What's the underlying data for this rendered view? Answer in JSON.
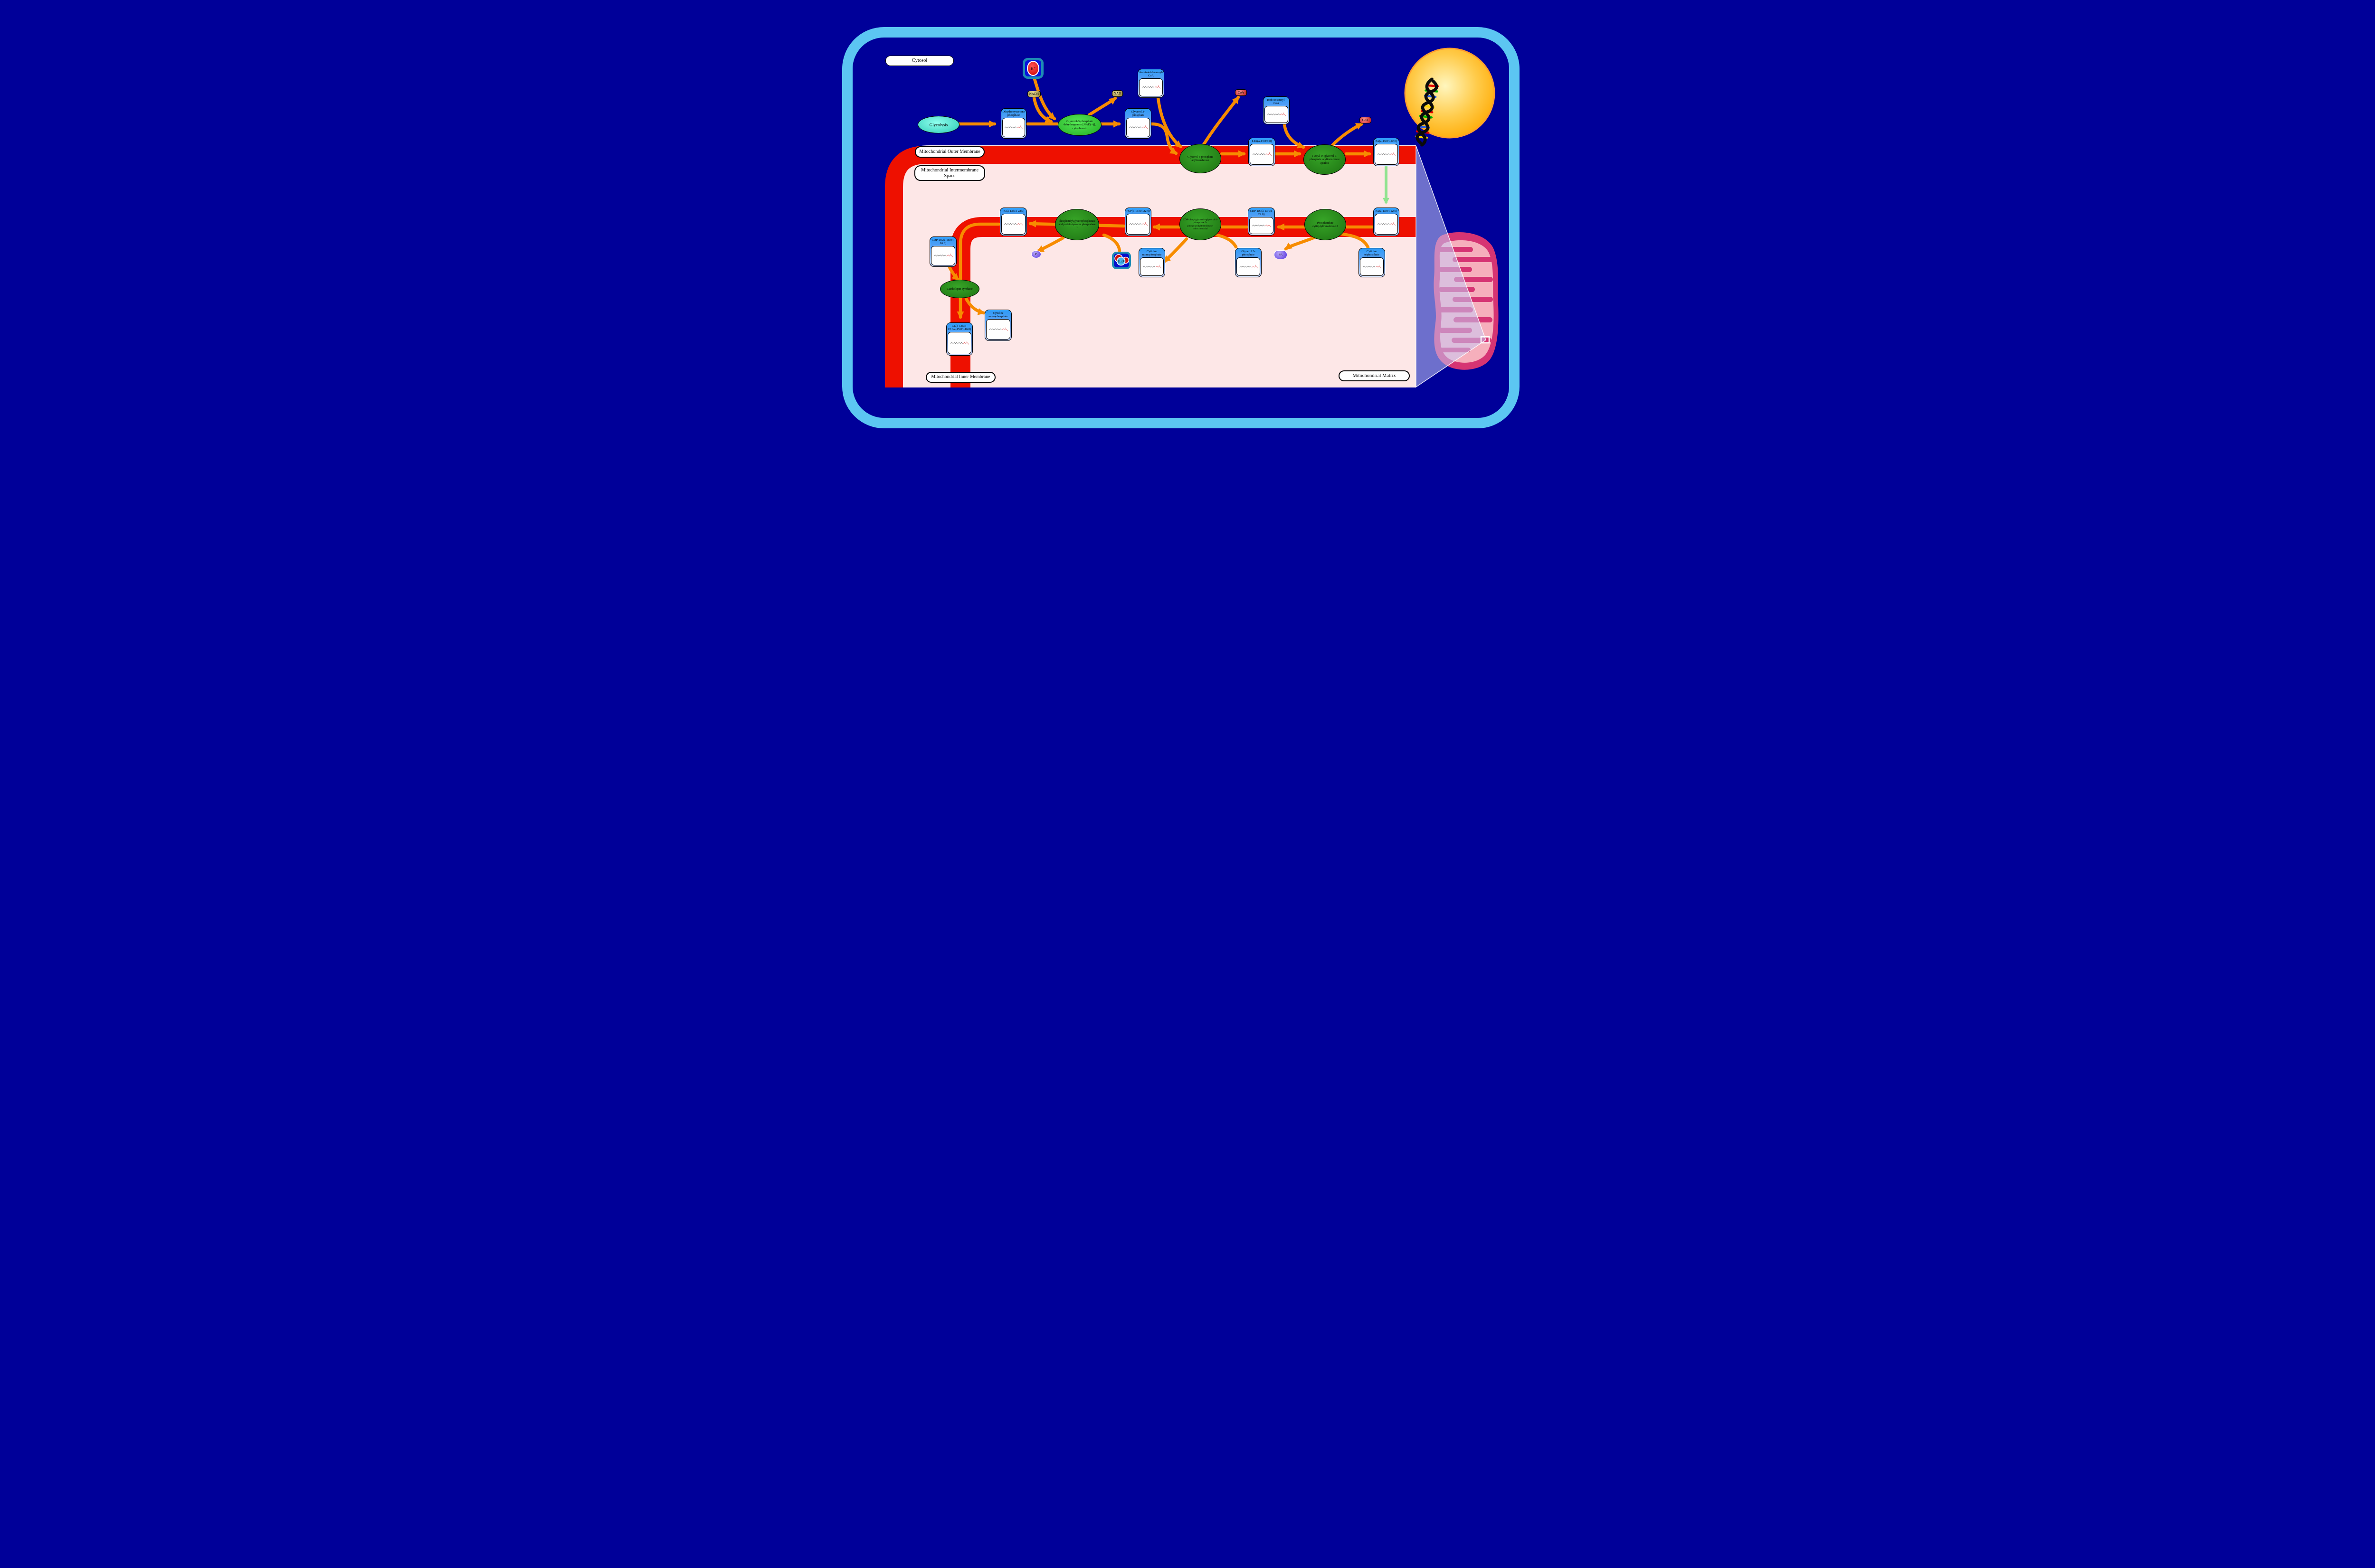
{
  "compartments": {
    "cytosol": "Cytosol",
    "outer_membrane": "Mitochondrial Outer Membrane",
    "intermembrane_space": "Mitochondrial Intermembrane Space",
    "inner_membrane": "Mitochondrial Inner Membrane",
    "matrix": "Mitochondrial Matrix"
  },
  "nodes": {
    "glycolysis": {
      "title": "Glycolysis"
    },
    "dhap": {
      "title": "Dihydroxyacetone phosphate"
    },
    "g3p_cytosol": {
      "title": "Glycerol 3-phosphate"
    },
    "anteisotridecanoyl_coa": {
      "title": "Anteisotridecanoyl-CoA"
    },
    "isodocosanoyl_coa": {
      "title": "Isodocosanoyl-CoA"
    },
    "lpa": {
      "title": "LPA(a-13:0/0:0)"
    },
    "pa_outer": {
      "title": "PA(a-13:0/i-22:0)"
    },
    "pa_inner": {
      "title": "PA(a-13:0/i-22:0)"
    },
    "cdp_dg_1": {
      "title": "CDP-DG(a-13:0/i-22:0)"
    },
    "pgp": {
      "title": "PGP(a-13:0/i-22:0)"
    },
    "pg": {
      "title": "PG(a-13:0/i-22:0)"
    },
    "cmp_1": {
      "title": "Cytidine monophosphate"
    },
    "g3p_matrix": {
      "title": "Glycerol 3-phosphate"
    },
    "ctp": {
      "title": "Cytidine triphosphate"
    },
    "cdp_dg_2": {
      "title": "CDP-DG(a-15:0/i-16:0)"
    },
    "cl": {
      "title": "CL(a-13:0/i-22:0/a-15:0/i-16:0)"
    },
    "cmp_2": {
      "title": "Cytidine monophosphate"
    }
  },
  "enzymes": {
    "gpd": "Glycerol-3-phosphate dehydrogenase [NAD(+)], cytoplasmic",
    "gpat": "Glycerol-3-phosphate acyltransferase",
    "agpat_epsilon": "1-Acyl-sn-glycerol-3-phosphate acyltransferase epsilon",
    "pct2": "Phosphatidate cytidylyltransferase 2",
    "cds": "CDP-diacylglycerol--glycerol-3-phosphate 3-phosphatidyltransferase, mitochondrial",
    "pgpase": "Phosphatidylglycerophosphatase and protein-tyrosine phosphatase 1",
    "cls": "Cardiolipin synthase"
  },
  "cofactors": {
    "nadh": "NADH",
    "nad": "NAD",
    "coa_1": "CoA",
    "coa_2": "CoA",
    "h_plus": "H⁺",
    "h2o": "H₂O",
    "pi": "Pᵢ",
    "ppi": "PPᵢ"
  },
  "colors": {
    "background": "#000099",
    "cell_border": "#5CC6F2",
    "membrane_red": "#EE1000",
    "interior_pink": "#FDE7E7",
    "arrow_orange": "#F78C00",
    "transport_green": "#8FE38F",
    "enzyme_green": "#1D7212",
    "enzyme_bright_green": "#2FD32F",
    "node_header_blue": "#2D9BF8",
    "nucleus_yellow": "#FFB400",
    "mitochondrion_pink": "#D63473"
  }
}
